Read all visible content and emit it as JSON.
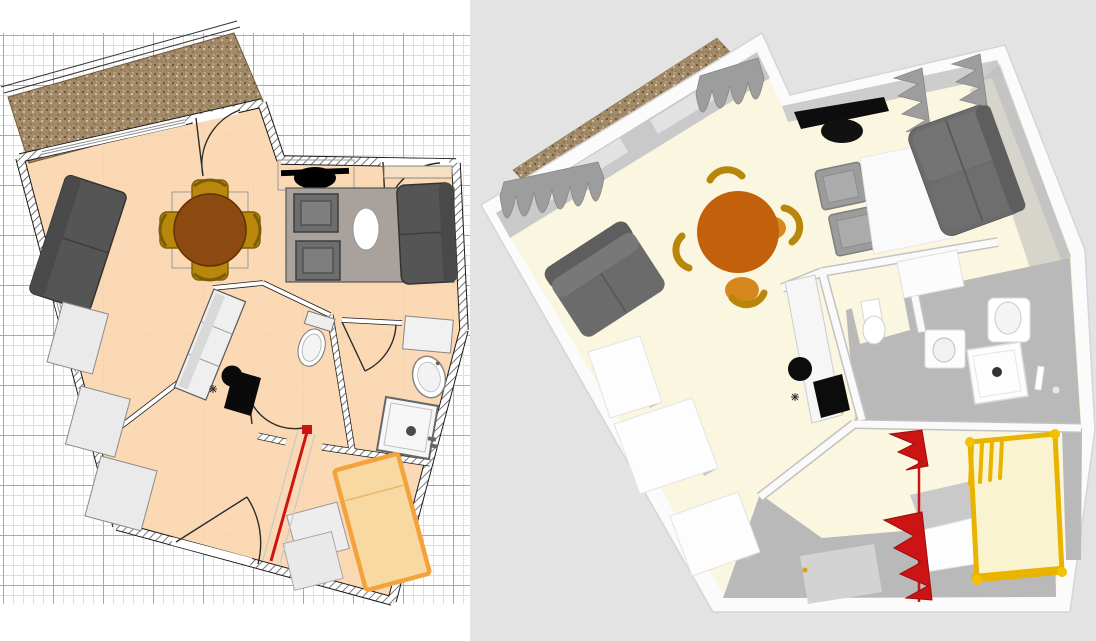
{
  "app": {
    "name": "home-design-editor",
    "description": "Studio apartment project shown as 2D floor plan (left) and 3D aerial view (right)"
  },
  "panels": {
    "plan_2d": {
      "label": "2D floor plan with grid"
    },
    "view_3d": {
      "label": "3D aerial view"
    }
  },
  "colors": {
    "plan_bg": "#ffffff",
    "grid_minor": "#dedede",
    "grid_major": "#a8a8a8",
    "plan_floor": "#fad7b0",
    "wall_line": "#1a1a1a",
    "balcony_base": "#a28a68",
    "balcony_speck_dark": "#6b5138",
    "balcony_speck_light": "#ddd2bd",
    "sofa_dark": "#555555",
    "table_wood": "#8d4a10",
    "chair_gold": "#b8870b",
    "rug": "#a9a19b",
    "armchair": "#6d6d6d",
    "bed_fill": "#f8d9a2",
    "bed_frame": "#f2a33c",
    "curtain_red": "#cc1414",
    "bg_3d": "#e3e3e3",
    "floor_3d": "#fbf6df",
    "wall_3d": "#fbfbfb",
    "wall_face_3d": "#c9c9c9",
    "floor_gray_3d": "#b9b9b9",
    "doormat_3d": "#d3d3d3",
    "sofa_3d": "#6b6b6b",
    "table_3d": "#c2600c",
    "chair_3d": "#b8860b",
    "curtain_gray": "#9d9d9d",
    "gold": "#e8b400",
    "bed_pale": "#faf3cf",
    "tv_black": "#0d0d0d"
  },
  "plan_2d": {
    "rooms": [
      "living-dining",
      "kitchen",
      "wc",
      "bathroom",
      "bedroom",
      "hallway",
      "balcony"
    ],
    "furniture": [
      "sofa-left",
      "dining-table",
      "dining-chair x4",
      "tv",
      "sideboard",
      "rug",
      "armchair x2",
      "coffee-table",
      "sofa-right",
      "kitchen-counter",
      "sink",
      "cooktop",
      "wardrobe x3",
      "toilet",
      "washbasin",
      "shower",
      "bathroom-cabinet",
      "bed",
      "dresser",
      "doormat",
      "red-curtain"
    ],
    "openings": {
      "windows": 3,
      "doors": 5
    }
  },
  "view_3d": {
    "furniture": [
      "balcony-deck",
      "window-curtains-gray x4",
      "sofa-left",
      "dining-table",
      "dining-chair x4",
      "tv",
      "armchair x2",
      "rug",
      "sofa-right",
      "kitchen-counter",
      "cooktop",
      "sink",
      "wardrobe x3",
      "toilet",
      "washing-machine",
      "washbasin",
      "shower-tray",
      "towel-rail",
      "gold-bed-frame",
      "dresser",
      "doormat",
      "red-curtain"
    ]
  }
}
